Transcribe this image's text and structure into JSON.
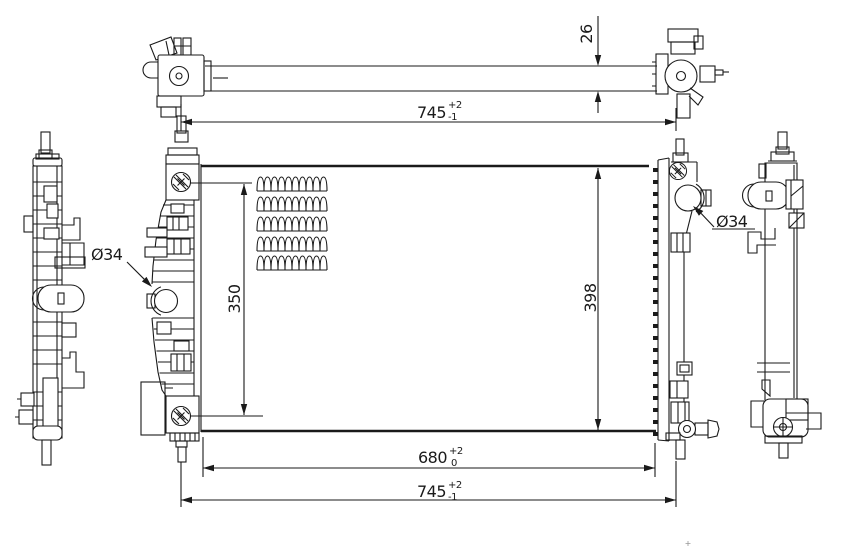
{
  "drawing": {
    "subject": "radiator-engineering-drawing",
    "line_color": "#1a1a1a",
    "background_color": "#ffffff",
    "dims": {
      "top_width": {
        "value": "745",
        "tol_up": "+2",
        "tol_dn": "-1"
      },
      "thickness": {
        "value": "26"
      },
      "inlet_span": {
        "value": "350"
      },
      "core_height": {
        "value": "398"
      },
      "pin_span": {
        "value": "680",
        "tol_up": "+2",
        "tol_dn": "0"
      },
      "overall_width": {
        "value": "745",
        "tol_up": "+2",
        "tol_dn": "-1"
      },
      "left_port_dia": "Ø34",
      "right_port_dia": "Ø34"
    }
  }
}
